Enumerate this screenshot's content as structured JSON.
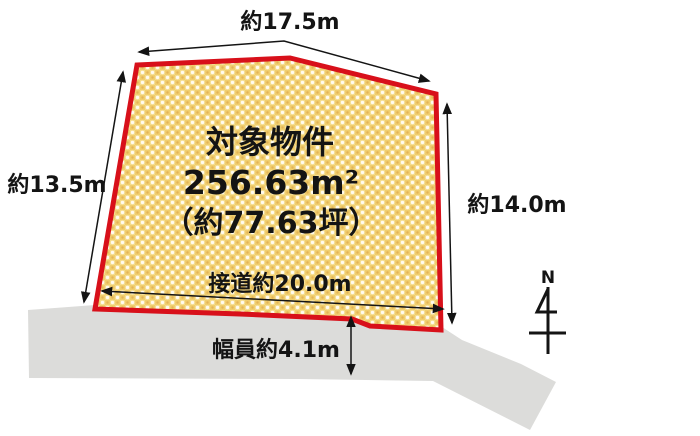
{
  "colors": {
    "plot_fill_base": "#F0CE6E",
    "plot_border": "#D8101A",
    "road_fill": "#DCDCDA",
    "line_color": "#141414"
  },
  "plot": {
    "title": "対象物件",
    "area": "256.63m²",
    "area_tsubo": "（約77.63坪）"
  },
  "dimensions": {
    "top_width": "約17.5m",
    "left_depth": "約13.5m",
    "right_depth": "約14.0m",
    "road_frontage": "接道約20.0m",
    "road_width": "幅員約4.1m"
  },
  "compass": {
    "north_label": "N"
  }
}
